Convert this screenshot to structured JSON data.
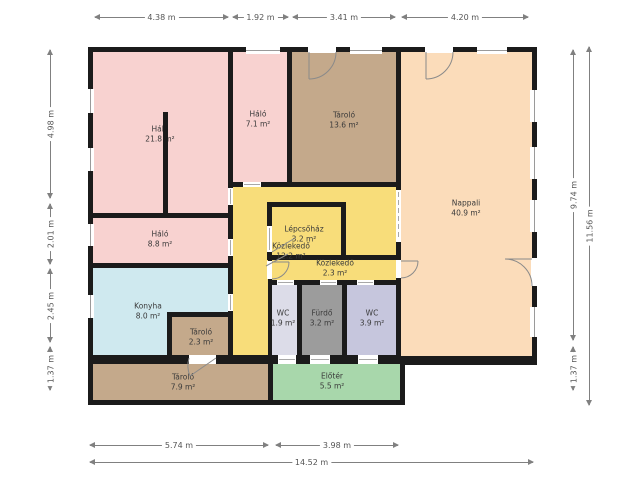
{
  "rooms": {
    "halo21": {
      "name": "Háló",
      "area": "21.8 m²",
      "color": "#f8d2d0"
    },
    "halo7": {
      "name": "Háló",
      "area": "7.1 m²",
      "color": "#f8d2d0"
    },
    "tarolo13": {
      "name": "Tároló",
      "area": "13.6 m²",
      "color": "#c4a98b"
    },
    "nappali": {
      "name": "Nappali",
      "area": "40.9 m²",
      "color": "#fbdcba"
    },
    "halo8": {
      "name": "Háló",
      "area": "8.8 m²",
      "color": "#f8d2d0"
    },
    "lepcsohaz": {
      "name": "Lépcsőház",
      "area": "3.2 m²",
      "color": "#f8dd7a"
    },
    "kozlekedo12": {
      "name": "Közlekedő",
      "area": "12.2 m²",
      "color": "#f8dd7a"
    },
    "kozlekedo2": {
      "name": "Közlekedő",
      "area": "2.3 m²",
      "color": "#f8dd7a"
    },
    "konyha": {
      "name": "Konyha",
      "area": "8.0 m²",
      "color": "#cfe9ef"
    },
    "tarolo2": {
      "name": "Tároló",
      "area": "2.3 m²",
      "color": "#c4a98b"
    },
    "wc1": {
      "name": "WC",
      "area": "1.9 m²",
      "color": "#dcdce8"
    },
    "furdo": {
      "name": "Fürdő",
      "area": "3.2 m²",
      "color": "#9c9c9c"
    },
    "wc2": {
      "name": "WC",
      "area": "3.9 m²",
      "color": "#c6c6dd"
    },
    "tarolo79": {
      "name": "Tároló",
      "area": "7.9 m²",
      "color": "#c4a98b"
    },
    "eloter": {
      "name": "Előtér",
      "area": "5.5 m²",
      "color": "#a8d7ab"
    }
  },
  "dims": {
    "top": [
      "4.38 m",
      "1.92 m",
      "3.41 m",
      "4.20 m"
    ],
    "left": [
      "4.98 m",
      "2.01 m",
      "2.45 m",
      "1.37 m"
    ],
    "right": [
      "9.74 m",
      "1.37 m",
      "11.56 m"
    ],
    "bottom": [
      "5.74 m",
      "3.98 m",
      "14.52 m"
    ]
  },
  "colors": {
    "wall": "#1b1b1b",
    "dimension_line": "#808080",
    "background": "#ffffff"
  }
}
